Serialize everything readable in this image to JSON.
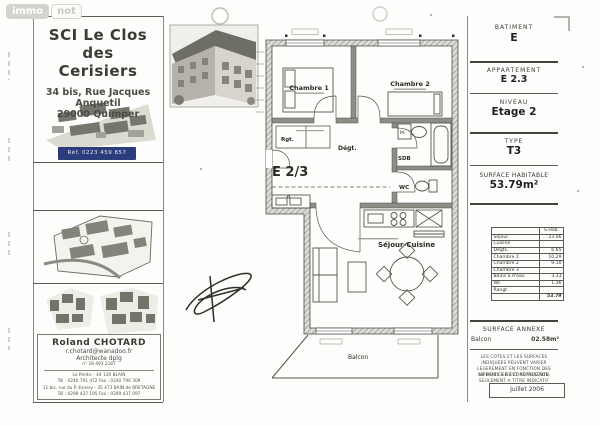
{
  "watermark": {
    "immo": "immo",
    "not": "not"
  },
  "title_block": {
    "title_line1": "SCI Le Clos des",
    "title_line2": "Cerisiers",
    "address_line1": "34 bis, Rue Jacques Anquetil",
    "address_line2": "29000 Quimper",
    "ref": "Réf. 0223 459 857"
  },
  "architect": {
    "name": "Roland CHOTARD",
    "email": "r.chotard@wanadoo.fr",
    "title": "Architecte dplg",
    "number": "n° 18 493 2187",
    "office1_address": "Le Pordic - 44 130 BLAIN",
    "office1_phone": "Tél : 0240 791 472   Fax : 0240 790 309",
    "office2_address": "11 bis, rue du P. Esnery - 35 473 BAIN de BRETAGNE",
    "office2_phone": "Tél : 0299 437 195   Fax : 0299 437 097"
  },
  "info_panel": {
    "batiment_label": "BATIMENT",
    "batiment_value": "E",
    "appartement_label": "APPARTEMENT",
    "appartement_value": "E 2.3",
    "niveau_label": "NIVEAU",
    "niveau_value": "Etage 2",
    "type_label": "TYPE",
    "type_value": "T3",
    "surface_label": "SURFACE HABITABLE",
    "surface_value": "53.79m²",
    "annexe_label": "SURFACE ANNEXE",
    "annexe_room": "Balcon",
    "annexe_value": "02.58m²",
    "legal1": "LES COTES ET LES SURFACES INDIQUEES PEUVENT VARIER LEGEREMENT EN FONCTION DES IMPERATIFS DE CONSTRUCTION.",
    "legal2": "LE MOBILIER EST REPRESENTE SEULEMENT A TITRE INDICATIF",
    "date": "Juillet 2006"
  },
  "surface_table": {
    "header": "S.Hab.",
    "rows": [
      [
        "Séjour",
        "23.06"
      ],
      [
        "Cuisine",
        ""
      ],
      [
        "Dégts.",
        "6.65"
      ],
      [
        "Chambre 1",
        "10.29"
      ],
      [
        "Chambre 2",
        "9.10"
      ],
      [
        "Chambre 3",
        ""
      ],
      [
        "Bains S.d'eau",
        "3.33"
      ],
      [
        "Wc",
        "1.36"
      ],
      [
        "Rangt",
        ""
      ]
    ],
    "total": "53.79"
  },
  "plan_labels": {
    "chambre1": "Chambre 1",
    "chambre2": "Chambre 2",
    "rgt": "Rgt.",
    "degt": "Dégt.",
    "unit": "E 2/3",
    "sdb": "SDB",
    "machine": "M.",
    "wc": "WC",
    "sejour": "Séjour-Cuisine",
    "balcon": "Balcon"
  }
}
